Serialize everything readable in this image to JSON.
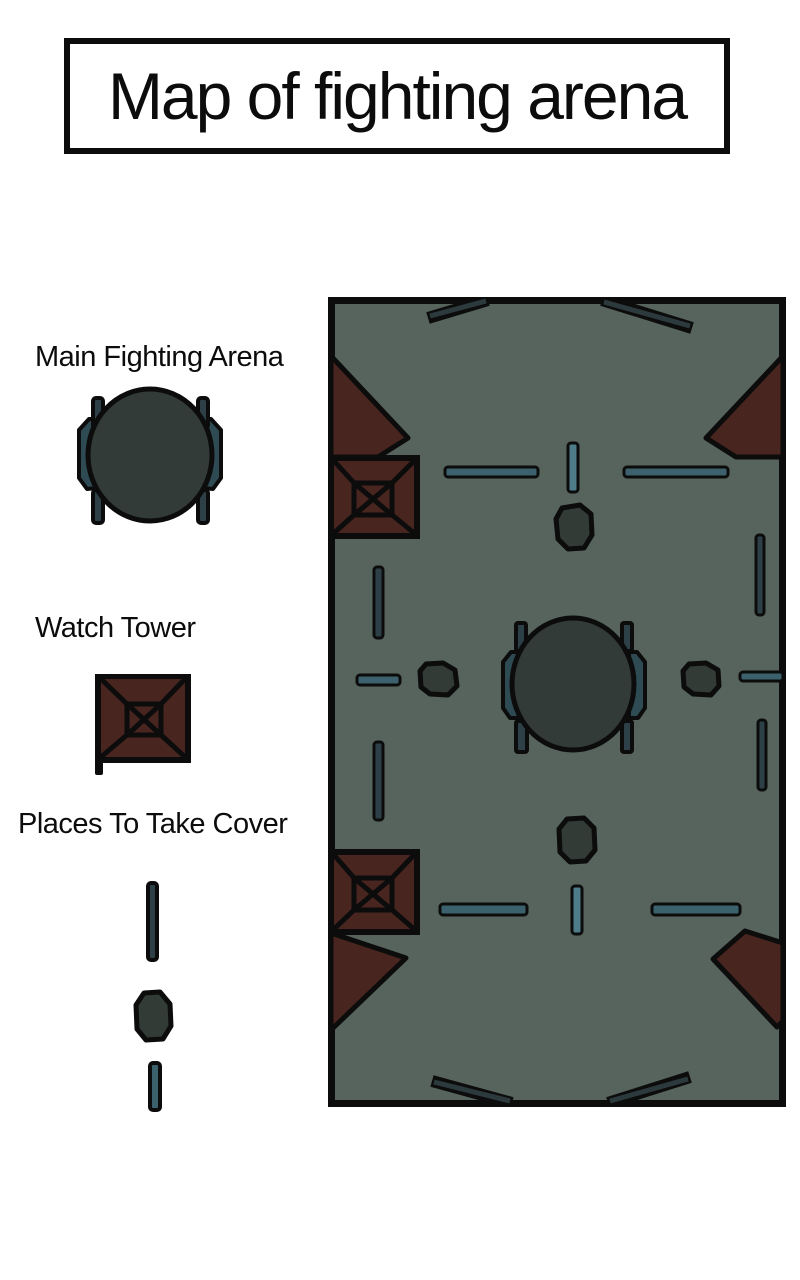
{
  "title": "Map of fighting arena",
  "legend": {
    "main_arena_label": "Main Fighting Arena",
    "watch_tower_label": "Watch Tower",
    "cover_label": "Places To Take Cover"
  },
  "map": {
    "name": "fighting-arena-map",
    "features": {
      "central_arena_count": 1,
      "watch_tower_count": 2,
      "corner_bunker_count": 4,
      "cover_rock_count": 4,
      "cover_wall_count": 12,
      "perimeter_diagonal_wall_count": 4
    }
  },
  "colors": {
    "page-bg": "#ffffff",
    "ink": "#0c0c0c",
    "map-bg": "#56645d",
    "red": "#48251f",
    "circle-fill": "#333b38",
    "rock-fill": "#333b37",
    "panel-teal": "#2e4b54",
    "bar-teal": "#3b626c",
    "bar-bright": "#4e7d89",
    "bar-slate": "#2e4047",
    "bar-dark": "#2c3a3d"
  }
}
